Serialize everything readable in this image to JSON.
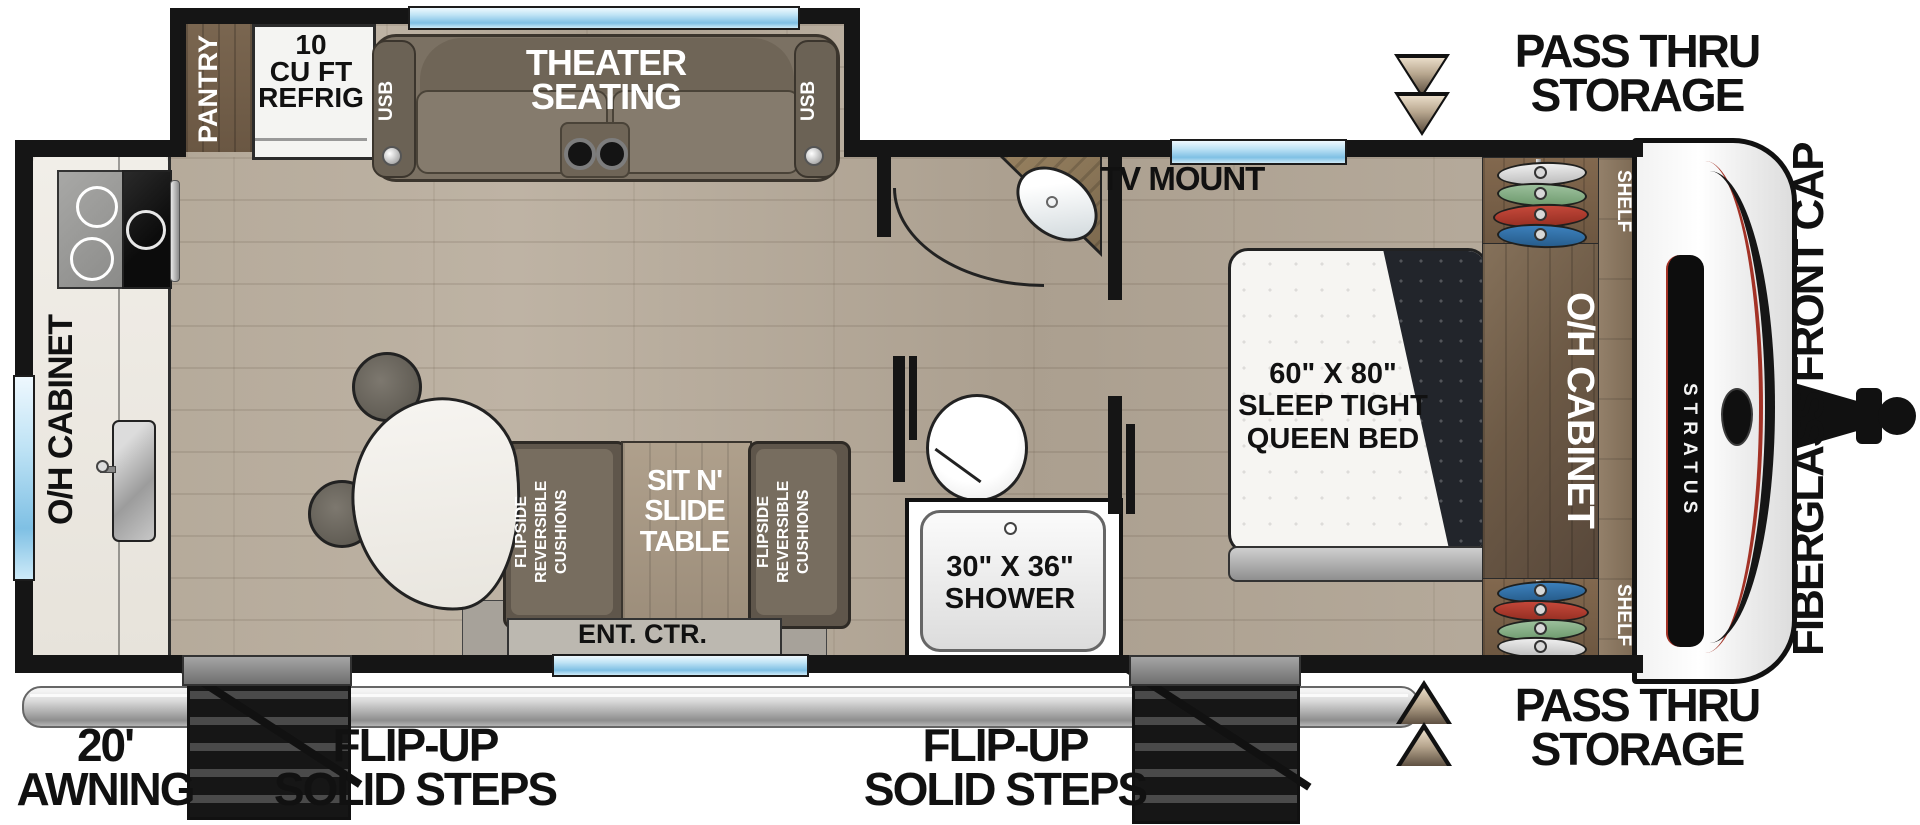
{
  "colors": {
    "wall": "#151515",
    "floor_wood": "#b5aa9b",
    "window_blue": "#9fd4ef",
    "counter_marble": "#efece6",
    "cabinet_brown": "#6d5a46",
    "closet_brown": "#7a6750",
    "bench_brown": "#6b6154",
    "table_wood": "#a89a87",
    "theater_brown": "#7b7163",
    "mattress_white": "#f6f5f2",
    "blanket_dark": "#23262b",
    "accent_red": "#a33226",
    "awning_silver": "#d9d9d9",
    "step_dark": "#2b2b2b",
    "arrow_tan": "#c7b59e",
    "hanger_white": "#d9d9d9",
    "hanger_green": "#84ae84",
    "hanger_red": "#b23a2c",
    "hanger_blue": "#2f6fa8"
  },
  "slideout": {
    "pantry_label": "PANTRY",
    "refrigerator_label": {
      "lines": [
        "10",
        "CU FT",
        "REFRIG"
      ]
    },
    "theater_label": {
      "lines": [
        "THEATER",
        "SEATING"
      ]
    },
    "usb_left": "USB",
    "usb_right": "USB"
  },
  "kitchen": {
    "overhead_cabinet_label": "O/H CABINET"
  },
  "dinette": {
    "left_cushion_label": {
      "lines": [
        "FLIPSIDE",
        "REVERSIBLE",
        "CUSHIONS"
      ]
    },
    "right_cushion_label": {
      "lines": [
        "FLIPSIDE",
        "REVERSIBLE",
        "CUSHIONS"
      ]
    },
    "table_label": {
      "lines": [
        "SIT N'",
        "SLIDE",
        "TABLE"
      ]
    },
    "entertainment_center_label": "ENT. CTR."
  },
  "bathroom": {
    "shower_label": {
      "lines": [
        "30\" X 36\"",
        "SHOWER"
      ]
    }
  },
  "bedroom": {
    "tv_mount_label": "TV MOUNT",
    "bed_label": {
      "lines": [
        "60\" X 80\"",
        "SLEEP TIGHT",
        "QUEEN BED"
      ]
    },
    "overhead_cabinet_label": "O/H CABINET",
    "shelf_top_label": "SHELF",
    "shelf_bottom_label": "SHELF"
  },
  "front_cap": {
    "brand": "STRATUS",
    "label": "FIBERGLASS FRONT CAP"
  },
  "exterior": {
    "pass_thru_top": {
      "lines": [
        "PASS THRU",
        "STORAGE"
      ]
    },
    "pass_thru_bottom": {
      "lines": [
        "PASS THRU",
        "STORAGE"
      ]
    },
    "awning_label": {
      "lines": [
        "20'",
        "AWNING"
      ]
    },
    "steps_left_label": {
      "lines": [
        "FLIP-UP",
        "SOLID STEPS"
      ]
    },
    "steps_right_label": {
      "lines": [
        "FLIP-UP",
        "SOLID STEPS"
      ]
    }
  }
}
